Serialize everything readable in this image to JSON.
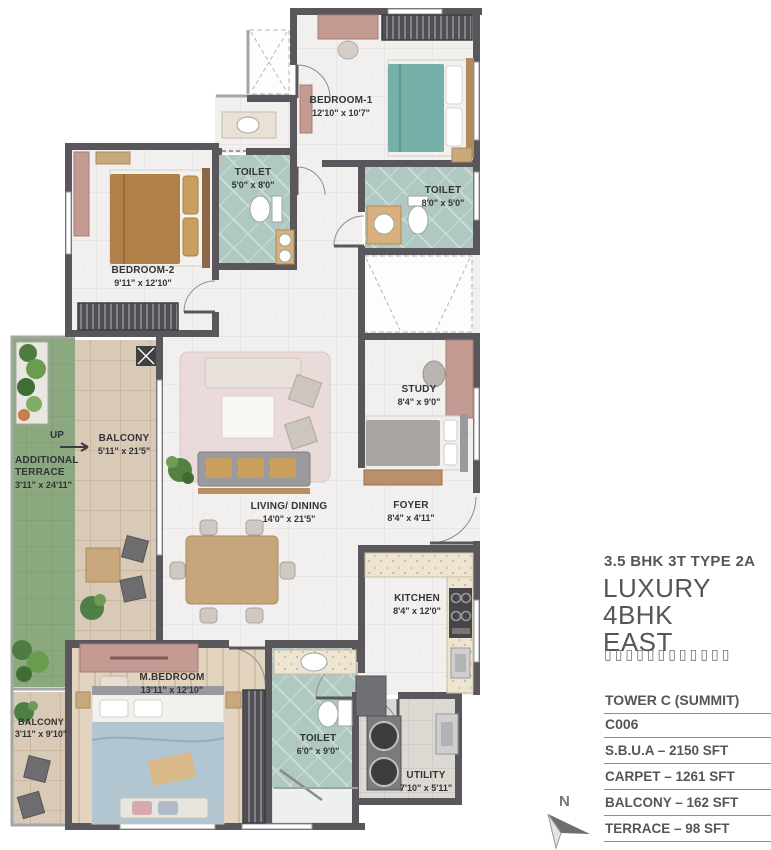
{
  "panel": {
    "type_label": "3.5 BHK 3T TYPE 2A",
    "title_line1": "LUXURY 4BHK",
    "title_line2": "EAST",
    "glyph_placeholder_row": "▯▯▯▯▯▯▯▯▯▯▯▯",
    "table": {
      "header": "TOWER C (SUMMIT)",
      "unit": "C006",
      "rows": [
        "S.B.U.A  – 2150 SFT",
        "CARPET  – 1261 SFT",
        "BALCONY  – 162 SFT",
        "TERRACE – 98 SFT"
      ]
    },
    "compass_label": "N"
  },
  "plan": {
    "up_label": "UP",
    "rooms": [
      {
        "name": "BEDROOM-1",
        "dims": "12'10\" x 10'7\""
      },
      {
        "name": "TOILET",
        "dims": "5'0\" x 8'0\""
      },
      {
        "name": "TOILET",
        "dims": "8'0\" x 5'0\""
      },
      {
        "name": "BEDROOM-2",
        "dims": "9'11\" x 12'10\""
      },
      {
        "name": "BALCONY",
        "dims": "5'11\" x 21'5\""
      },
      {
        "name": "ADDITIONAL TERRACE",
        "dims": "3'11\" x 24'11\""
      },
      {
        "name": "STUDY",
        "dims": "8'4\" x 9'0\""
      },
      {
        "name": "LIVING/ DINING",
        "dims": "14'0\" x 21'5\""
      },
      {
        "name": "FOYER",
        "dims": "8'4\" x 4'11\""
      },
      {
        "name": "KITCHEN",
        "dims": "8'4\" x 12'0\""
      },
      {
        "name": "M.BEDROOM",
        "dims": "13'11\" x 12'10\""
      },
      {
        "name": "BALCONY",
        "dims": "3'11\" x 9'10\""
      },
      {
        "name": "TOILET",
        "dims": "6'0\" x 9'0\""
      },
      {
        "name": "UTILITY",
        "dims": "7'10\" x 5'11\""
      }
    ],
    "colors": {
      "wall": "#59575b",
      "toilet_tile": "#afc9c2",
      "balcony_tile": "#d9cab8",
      "terrace_green": "#8ba87e",
      "wood_floor": "#e3d4c0",
      "marble": "#f1f0ef",
      "accent_wood": "#c49b93"
    }
  }
}
